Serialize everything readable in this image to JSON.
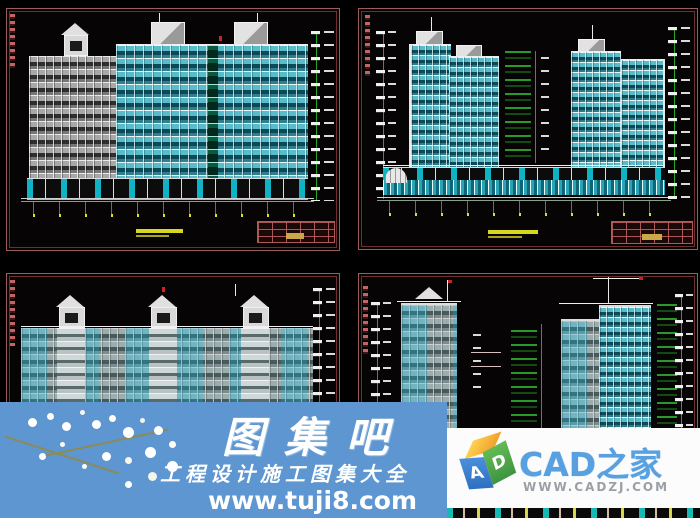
{
  "page": {
    "background": "#000000"
  },
  "drawing_sheets": [
    {
      "id": "top-left",
      "kind": "residential-building-elevation",
      "frame_color": "#9c5c5c"
    },
    {
      "id": "top-right",
      "kind": "twin-tower-with-podium-elevation",
      "frame_color": "#9c5c5c"
    },
    {
      "id": "bottom-left",
      "kind": "slab-block-elevation-three-pavilions",
      "frame_color": "#9c5c5c"
    },
    {
      "id": "bottom-right",
      "kind": "twin-tower-side-elevation-with-crane",
      "frame_color": "#9c5c5c"
    }
  ],
  "colors": {
    "window_cyan": "#58bccb",
    "facade_gray": "#a8a8a8",
    "dimension_green": "#23a623",
    "annotation_red": "#c46464",
    "drawing_title_yellow": "#d7d71e",
    "title_block_red": "#b05858"
  },
  "watermark_tuji8": {
    "title": "图集吧",
    "subtitle": "工程设计施工图集大全",
    "url": "www.tuji8.com",
    "background": "#5d96d0",
    "text_color": "#ffffff"
  },
  "watermark_cadzj": {
    "site_name": "CAD之家",
    "url": "WWW.CADZJ.COM",
    "cube_letter_a": "A",
    "cube_letter_d": "D",
    "background": "#fcfcfc",
    "name_color": "#58a0e0",
    "url_color": "#9aa0a6"
  }
}
